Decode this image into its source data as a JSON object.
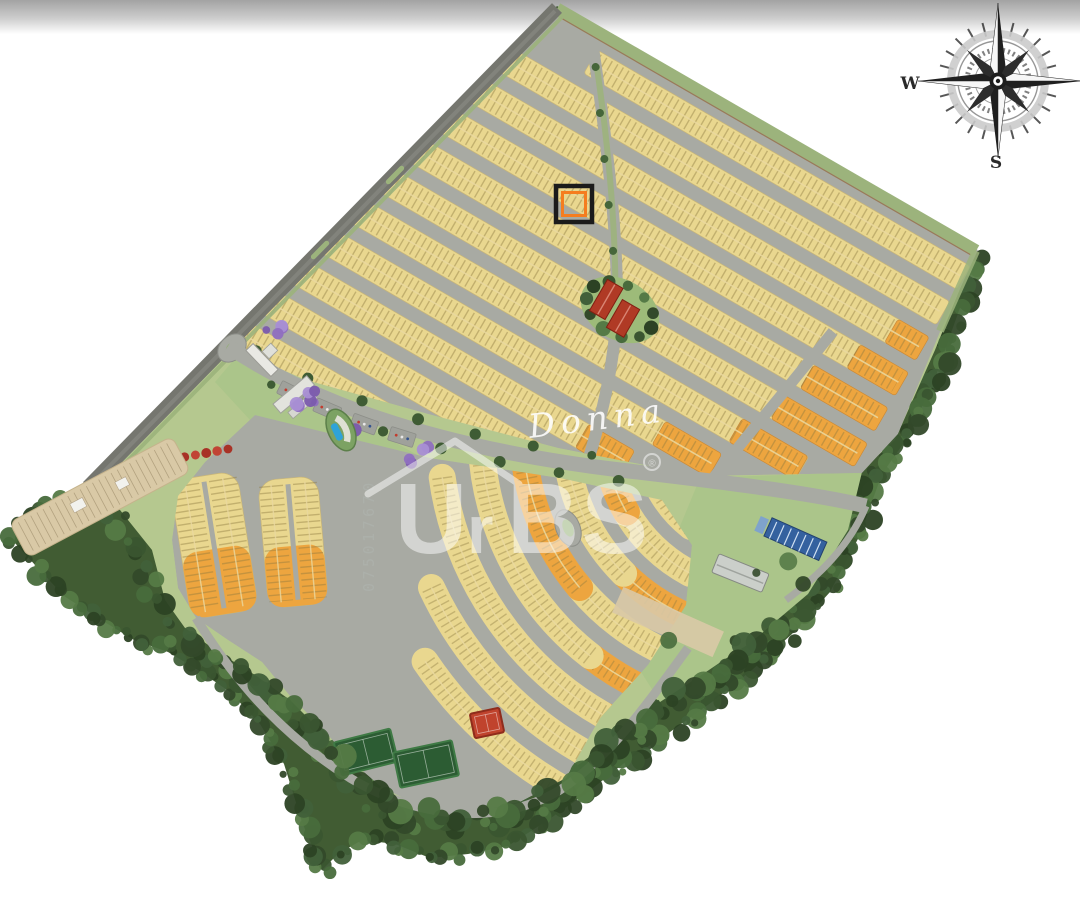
{
  "image_kind": "residential-lots-masterplan",
  "compass": {
    "west": "W",
    "south": "S"
  },
  "watermarks": {
    "script_signature": "Donna",
    "brand_u": "U",
    "brand_r": "r",
    "brand_bs": "BS",
    "registered_mark": "®",
    "vertical_id": "075017670"
  },
  "highlighted_lot": {
    "outer_ring": "#1b1b1b",
    "inner_ring": "#f57d1f"
  },
  "palette": {
    "lot_yellow": "#e9d78f",
    "lot_orange": "#eda53f",
    "road_gray": "#a8aaa3",
    "perimeter_road": "#75766f",
    "grass_light": "#b5c88f",
    "lawn": "#abc58a",
    "green_strip": "#9cb37c",
    "forest_dark": "#415c33",
    "clubhouse_red": "#b03a25",
    "pool_blue": "#2fa3d8",
    "court_green": "#2c5c33",
    "court_red": "#c0432d",
    "panel_blue": "#34619f",
    "sand_beige": "#d9c9a6",
    "tick_dark": "#8d7a40"
  }
}
